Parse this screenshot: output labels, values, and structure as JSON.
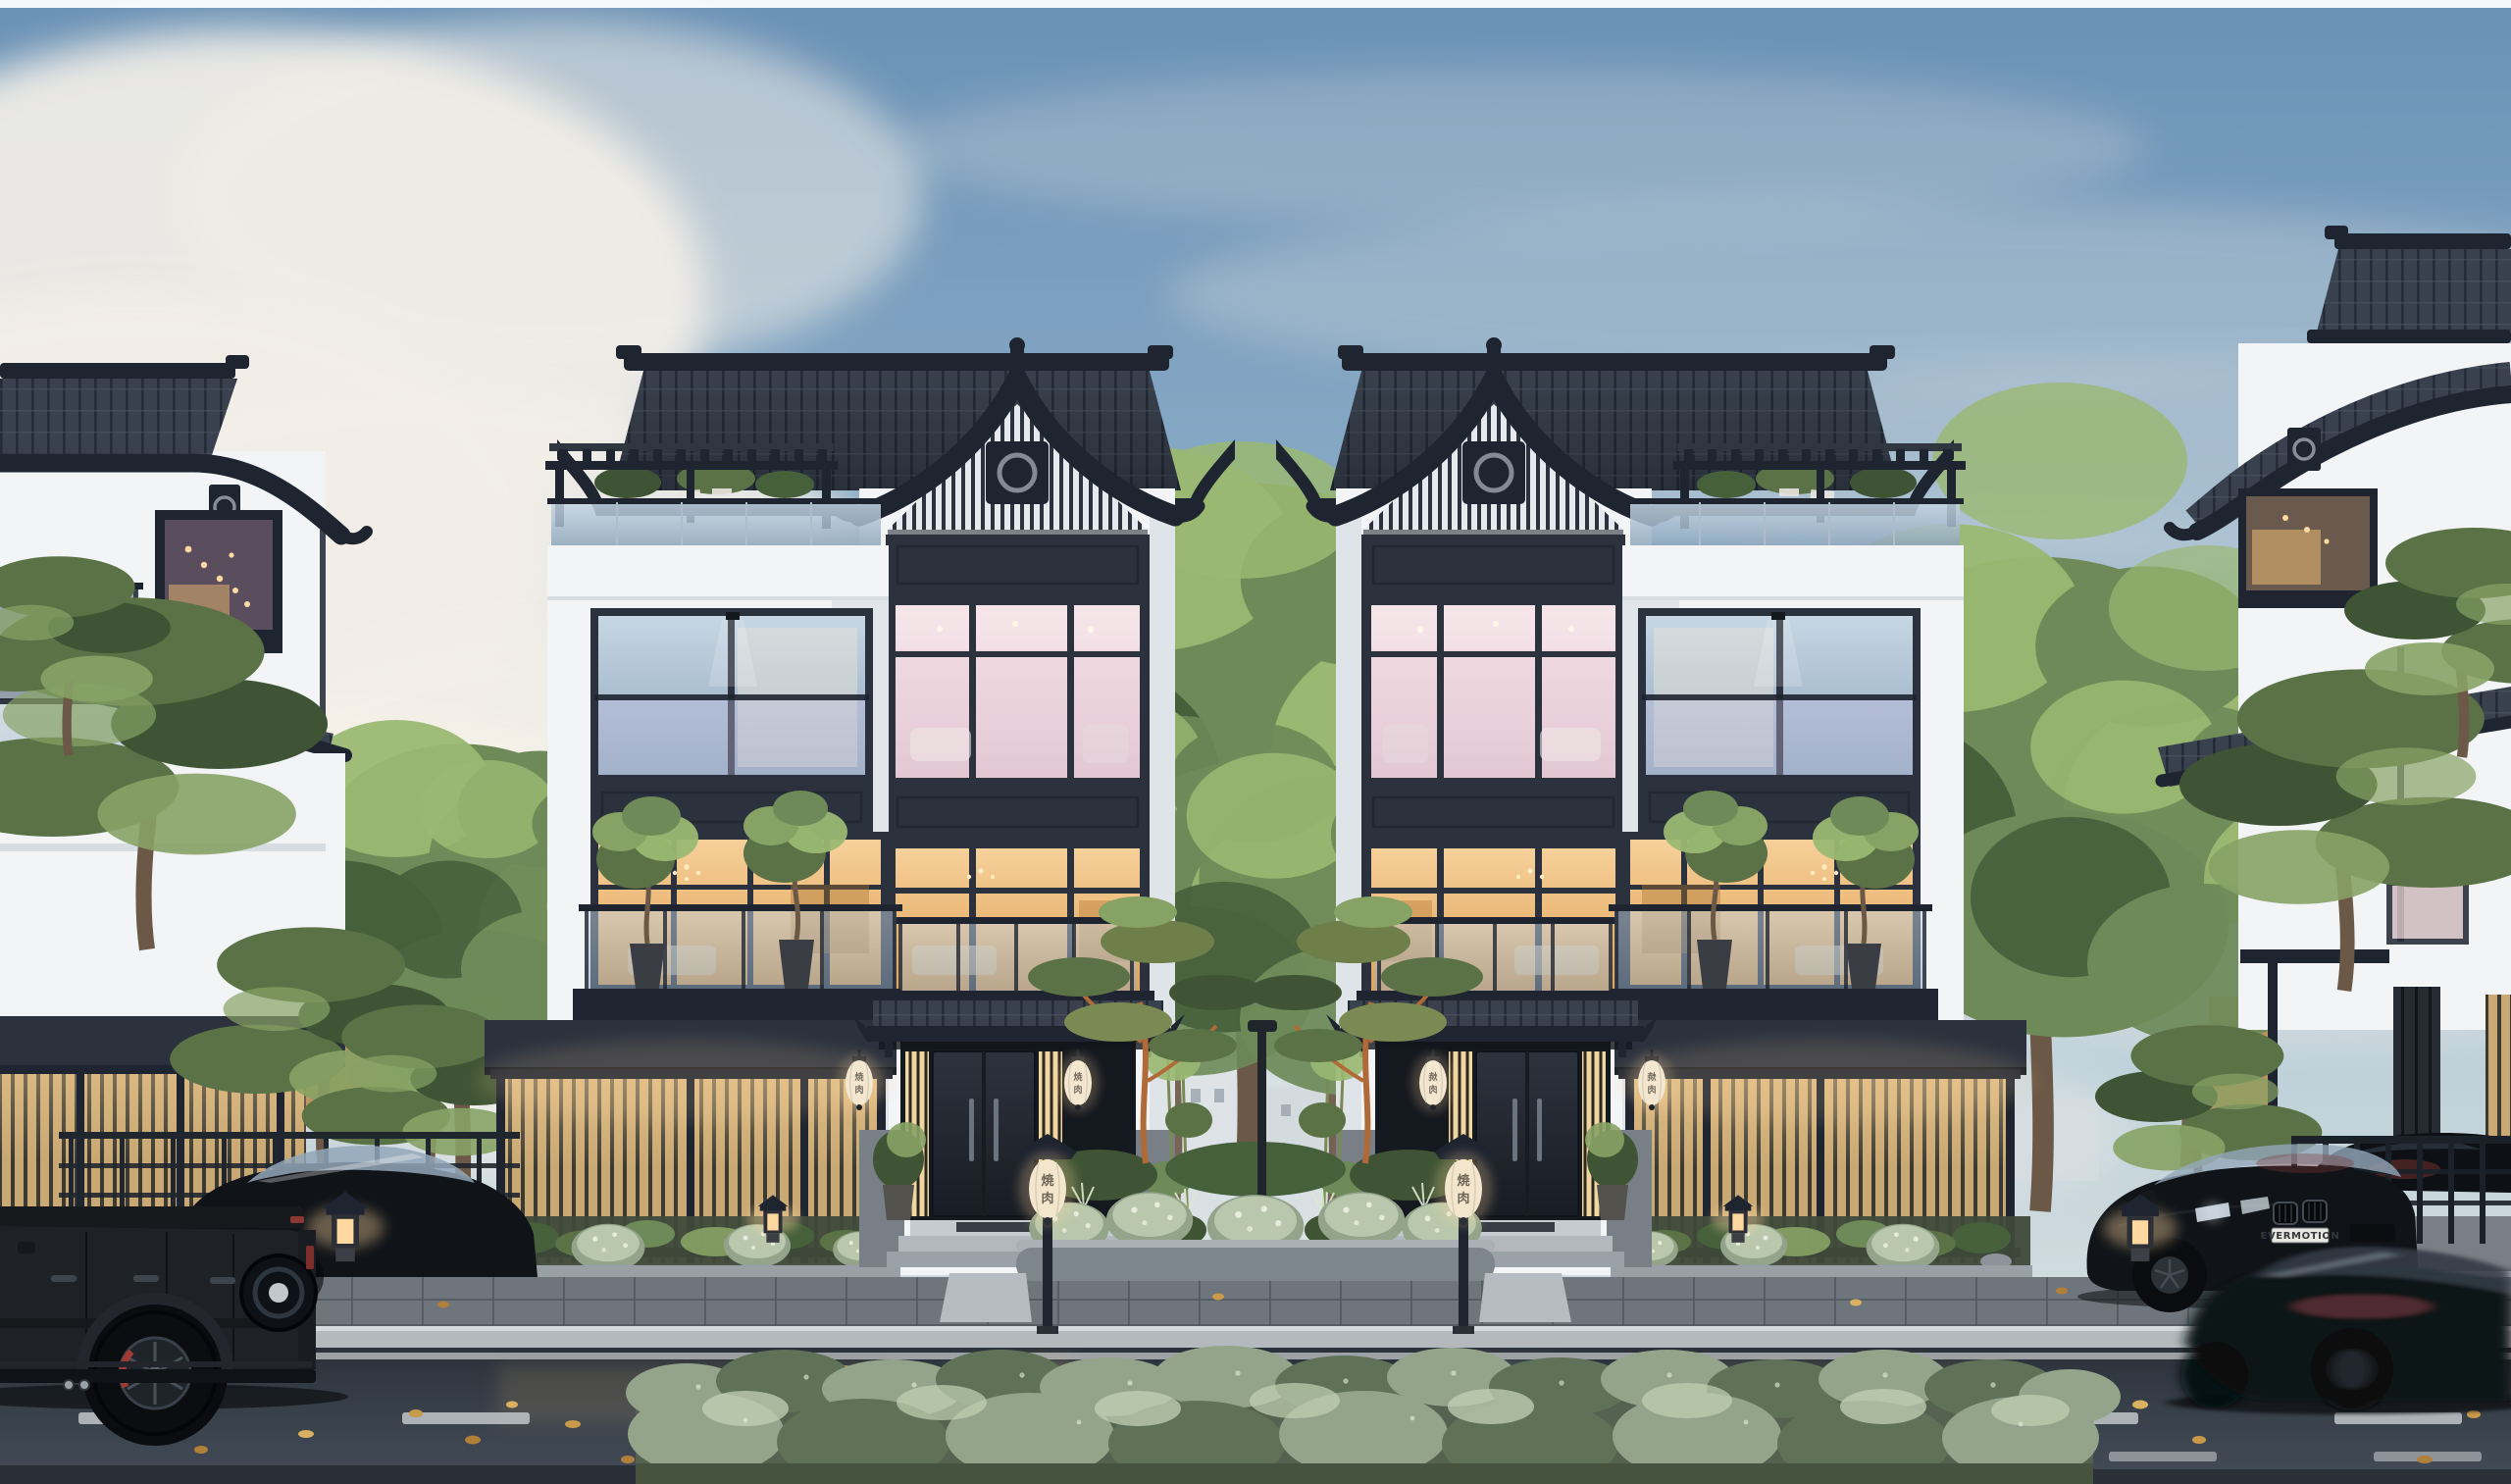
{
  "meta": {
    "domain": "Natural-Image",
    "description": "Photorealistic dusk architectural rendering of a luxury modern Chinese/Japanese-style townhouse street: two mirrored white villas with dark curved tile roofs and glowing windows, flanked by partial neighbor villas, pines and deciduous trees, a wet asphalt street with parked and moving black cars, lanterns and a long sage hedge in the foreground.",
    "time_of_day": "dusk, overcast-blue sky with large clouds",
    "weather": "recent rain, wet reflective street"
  },
  "texts": {
    "license_plate": "EVERMOTION",
    "lantern_glyph_top": "焼",
    "lantern_glyph_bottom": "肉"
  },
  "scene": {
    "buildings": [
      {
        "name": "left-neighbor-villa",
        "position": "far left, partially cropped",
        "features": [
          "dark sweeping tile roof",
          "round-motif plaque",
          "lit window with string lights",
          "glass balcony",
          "backlit timber slat fence",
          "overhanging pines"
        ]
      },
      {
        "name": "left-center-villa",
        "position": "center-left",
        "features": [
          "gabled tower with upswept charcoal tile roof and finial",
          "slatted gable with round-motif plaque",
          "pink-lit third-floor window wall",
          "amber-lit second-floor window wall",
          "juliet glass balcony",
          "rooftop pergola terrace with glass railing and shrubs",
          "balcony with potted olive trees",
          "dark entry awning with two white oval lanterns",
          "backlit bamboo slat fence",
          "stone base",
          "entry steps and post lantern"
        ]
      },
      {
        "name": "right-center-villa",
        "position": "center-right",
        "mirror_of": "left-center-villa"
      },
      {
        "name": "right-neighbor-villa",
        "position": "far right, partially cropped",
        "features": [
          "tall tile roof cap",
          "sweeping gable roof",
          "round-motif plaque",
          "warm lit window",
          "tan lit side wall",
          "dark louver screen",
          "pines"
        ]
      }
    ],
    "vehicles": [
      {
        "name": "black G-Class SUV",
        "position": "foreground left, rear half in frame",
        "details": [
          "rear-mounted spare wheel",
          "red brake caliper",
          "dark alloy wheels",
          "side exhaust tips"
        ]
      },
      {
        "name": "black sports coupe",
        "position": "parked behind the SUV",
        "details": [
          "bright reflective canopy glass"
        ]
      },
      {
        "name": "black BMW coupe",
        "position": "parked right, facing camera",
        "license_plate": "EVERMOTION",
        "details": [
          "kidney grilles",
          "lit headlights",
          "red reflections on glass"
        ]
      },
      {
        "name": "dark sedan",
        "position": "behind right railing, partially hidden"
      },
      {
        "name": "motion-blurred black coupe",
        "position": "foreground right, driving past",
        "details": [
          "red-pink light streak on flank"
        ]
      }
    ],
    "landscape": [
      "tall deciduous trees between villas",
      "japanese pines with orange branches in center planter",
      "white-flower bushes",
      "sage foreground hedge with pale speckles",
      "bamboo by entrances",
      "grasses in front beds"
    ],
    "street_elements": [
      "dark paver sidewalk",
      "light stone curb",
      "continuous white edge line",
      "dashed lane line",
      "scattered golden fallen leaves",
      "wet reflections of backlit fences",
      "center street lamp pole",
      "glowing garden and post lanterns",
      "metal guard railings"
    ]
  },
  "palette": {
    "sky-top": "#6a91b5",
    "sky-mid": "#8fb0ca",
    "sky-low": "#c2d3da",
    "sky-horizon": "#dfe5e6",
    "cloud": "#f3efe8",
    "frame": "#2b313d",
    "frame-dk": "#1e2430",
    "roof": "#39414e",
    "roof-dk": "#242b36",
    "roof-lt": "#4d5664",
    "wall": "#f2f4f6",
    "wall-sh": "#ccd3dc",
    "stone": "#9aa1a8",
    "stone-dk": "#787f86",
    "glass-1": "#c6d6e4",
    "glass-2": "#8fa7bd",
    "amber-1": "#f6d09a",
    "amber-2": "#e0a257",
    "pink-1": "#f4dfe4",
    "pink-2": "#e3c8d4",
    "door-1": "#2d333d",
    "door-2": "#181c24",
    "slat": "#c9a873",
    "slat-lit": "#f0d6a0",
    "slat-gap": "#3a3a33",
    "glow-warm": "#ffd9a0",
    "lantern": "#f1ebdc",
    "pine": "#5a7246",
    "pine-dk": "#3f5434",
    "pine-lt": "#87a265",
    "tree": "#6d8a58",
    "tree-dk": "#46603c",
    "tree-lt": "#9ab872",
    "trunk": "#6b5846",
    "branch": "#b06a38",
    "hedge": "#93a48b",
    "hedge-dk": "#5f7258",
    "hedge-lt": "#c3d1b4",
    "sidewalk": "#6e757d",
    "curb": "#b4b9bd",
    "asphalt-1": "#2a3139",
    "asphalt-2": "#434c57",
    "lane": "#c2c7ca",
    "leaf": "#c89a4a",
    "car": "#101318",
    "car-glass": "#3e4c5c",
    "car-glass-lt": "#93a7ba",
    "red": "#8f3a32",
    "plate": "#e9e7e1",
    "tan-wall": "#bb8d58"
  }
}
